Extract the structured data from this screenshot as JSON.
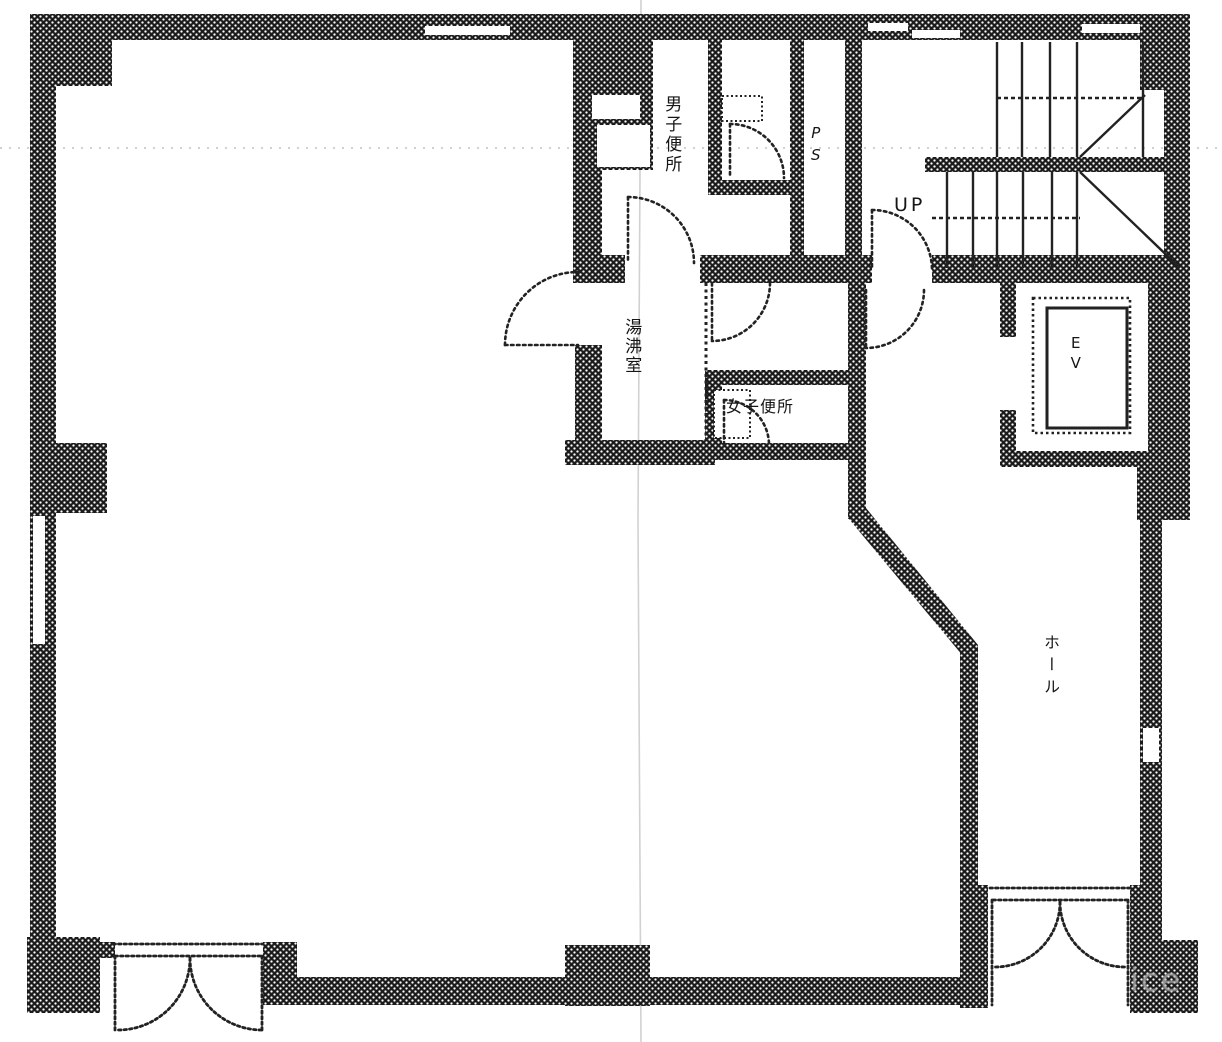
{
  "floor_plan": {
    "labels": {
      "mens_toilet": "男子便所",
      "pipe_space": "PS",
      "stairs_up": "UP",
      "elevator": "EV",
      "kitchenette": "湯沸室",
      "womens_toilet": "女子便所",
      "hall": "ホール"
    },
    "watermark": "ice",
    "colors": {
      "ink": "#1c1c1c",
      "paper": "#ffffff",
      "crease": "#bdbdbd",
      "watermark_gray": "#ababab"
    }
  }
}
